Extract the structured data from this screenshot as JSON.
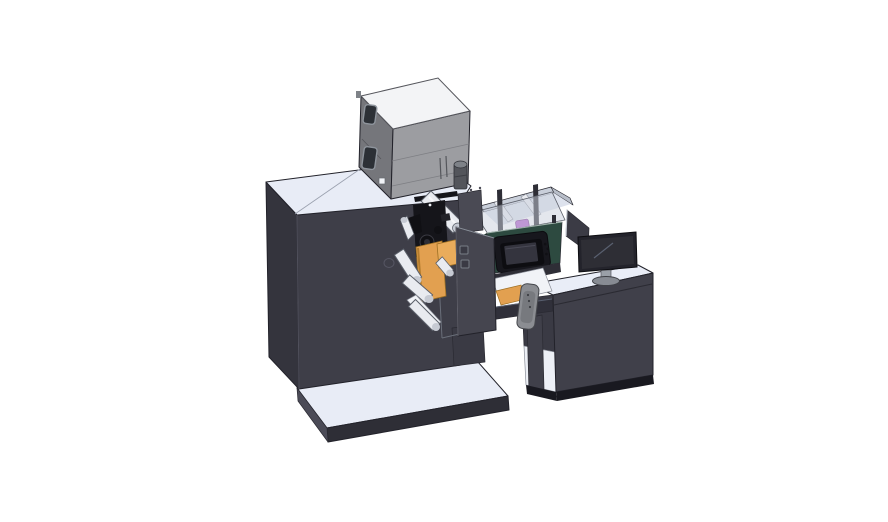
{
  "scene": {
    "description": "Isometric 3D CAD render of an industrial roll-fed printing/label machine: gray supply box on top of a dark cabinet, unwinder rollers with orange guide plates, a transparent process enclosure with purple cartridge, a dark-green control panel with touchscreen, a hanging control pendant, an operator desk with monitor, and a light base platform.",
    "background": "#ffffff"
  },
  "palette": {
    "outline": "#22222a",
    "body_front": "#3E3E48",
    "body_side": "#34343D",
    "body_top": "#E8ECF6",
    "box_front": "#9C9DA1",
    "box_side": "#75767B",
    "box_top": "#F3F4F6",
    "box_window": "#2C3036",
    "cylinder_dark": "#53555B",
    "cylinder_top": "#7E8288",
    "orange": "#E2A050",
    "orange_light": "#E9AC5B",
    "orange_dark": "#9C6F23",
    "green_front": "#2D4A40",
    "green_side": "#1E342C",
    "screen_black": "#17171D",
    "screen_mid": "#0D0D11",
    "screen_inner": "#34343E",
    "black_part": "#15151A",
    "black_deep": "#101014",
    "roller": "#E9EBF0",
    "roller_cap": "#C6CAD3",
    "plate_white": "#F1F3F7",
    "purple": "#B55ECF",
    "encl_back": "#C9CFDA",
    "encl_right": "#B8BEC9",
    "encl_floor": "#DDE2ED",
    "encl_glass": "rgba(201,208,220,0.5)",
    "post_dark": "#2E2E36",
    "door_gray": "#45454F",
    "door_top": "#4A4A54",
    "frame_dark": "#30303A",
    "leg_dark": "#3A3A44",
    "pendant": "#8B8D92",
    "pendant_inner": "#77797E",
    "desk_top": "#E9EDF7",
    "desk_front": "#40404A",
    "desk_side_dark": "#3A3A44",
    "desk_plinth": "#191920",
    "shelf_white": "#EDF0F6",
    "divider": "#3B3B45",
    "monitor_bezel": "#23232B",
    "monitor_screen": "#2E2E35",
    "monitor_base": "#878B93",
    "neck_gray": "#9AA0A8",
    "platform_top": "#E8ECF6",
    "platform_front": "#2E2E36",
    "platform_side": "#4B4B57"
  }
}
